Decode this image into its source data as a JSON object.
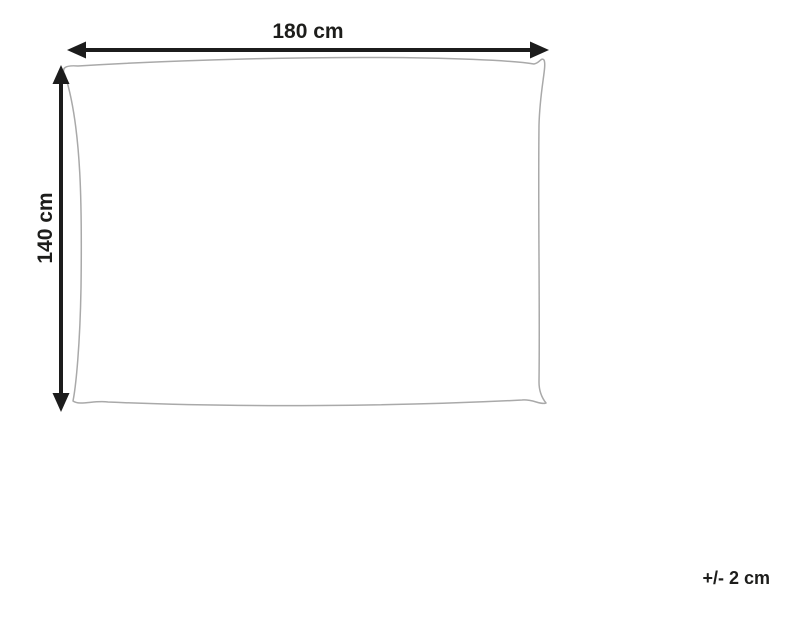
{
  "diagram": {
    "width_label": "180 cm",
    "height_label": "140 cm",
    "tolerance_label": "+/- 2 cm",
    "colors": {
      "arrow": "#1c1c1c",
      "text": "#1d1d1b",
      "outline": "#a9a9a9",
      "background": "#ffffff"
    }
  }
}
